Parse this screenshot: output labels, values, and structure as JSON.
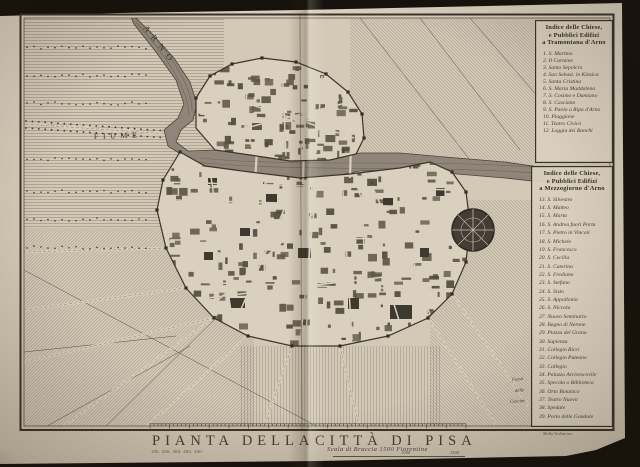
{
  "map": {
    "title_left": "PIANTA DELLA",
    "title_right": "CITTÀ DI PISA",
    "scale_label": "Scala di Braccia 1500 Fiorentine",
    "scale_small_numbers": "100. 200. 300. 400. 500.",
    "scale_mid_number": "1000",
    "scale_end_number": "1500",
    "river_label_top": "ARNO",
    "river_label_left": "FIUME",
    "area_label_lines": [
      "Fosso",
      "delle",
      "Cascine"
    ],
    "engraver_credit": "Molla Violani inc."
  },
  "legend_north": {
    "title_lines": [
      "Indice delle Chiese,",
      "e Pubblici Edifizi",
      "a Tramontana d'Arno"
    ],
    "items": [
      "1. S. Martino",
      "2. Il Carmine",
      "3. Santo Sepolcro",
      "4. San Sebast. in Kinsica",
      "5. Santa Cristina",
      "6. S. Maria Maddalena",
      "7. S. Cosimo e Damiano",
      "8. S. Casciano",
      "9. S. Paolo a Ripa d'Arno",
      "10. Piaggione",
      "11. Teatro Civico",
      "12. Loggia dei Banchi"
    ]
  },
  "legend_south": {
    "title_lines": [
      "Indice delle Chiese,",
      "e Pubblici Edifizi",
      "a Mezzogiorno d'Arno"
    ],
    "items": [
      "13. S. Silvestro",
      "14. S. Matteo",
      "15. S. Marta",
      "16. S. Andrea fuori Porta",
      "17. S. Pietro in Vincoli",
      "18. S. Michele",
      "19. S. Francesco",
      "20. S. Cecilia",
      "21. S. Caterina",
      "22. S. Frediano",
      "23. S. Stefano",
      "24. S. Sisto",
      "25. S. Appollonia",
      "26. S. Niccola",
      "27. Nuovo Seminario",
      "28. Bagno di Nerone",
      "29. Piazza del Grano",
      "30. Sapienza",
      "31. Collegio Ricci",
      "32. Collegio Puteano",
      "33. Collegio",
      "34. Palazzo Arcivescovile",
      "35. Specola o Biblioteca",
      "36. Orto Botanico",
      "37. Teatro Nuovo",
      "38. Spedale",
      "39. Porto delle Gondole"
    ]
  },
  "colors": {
    "background": "#16110c",
    "paper": "#d6ccba",
    "ink": "#4a4238",
    "river": "#8f8679",
    "wall": "#3c352b"
  }
}
